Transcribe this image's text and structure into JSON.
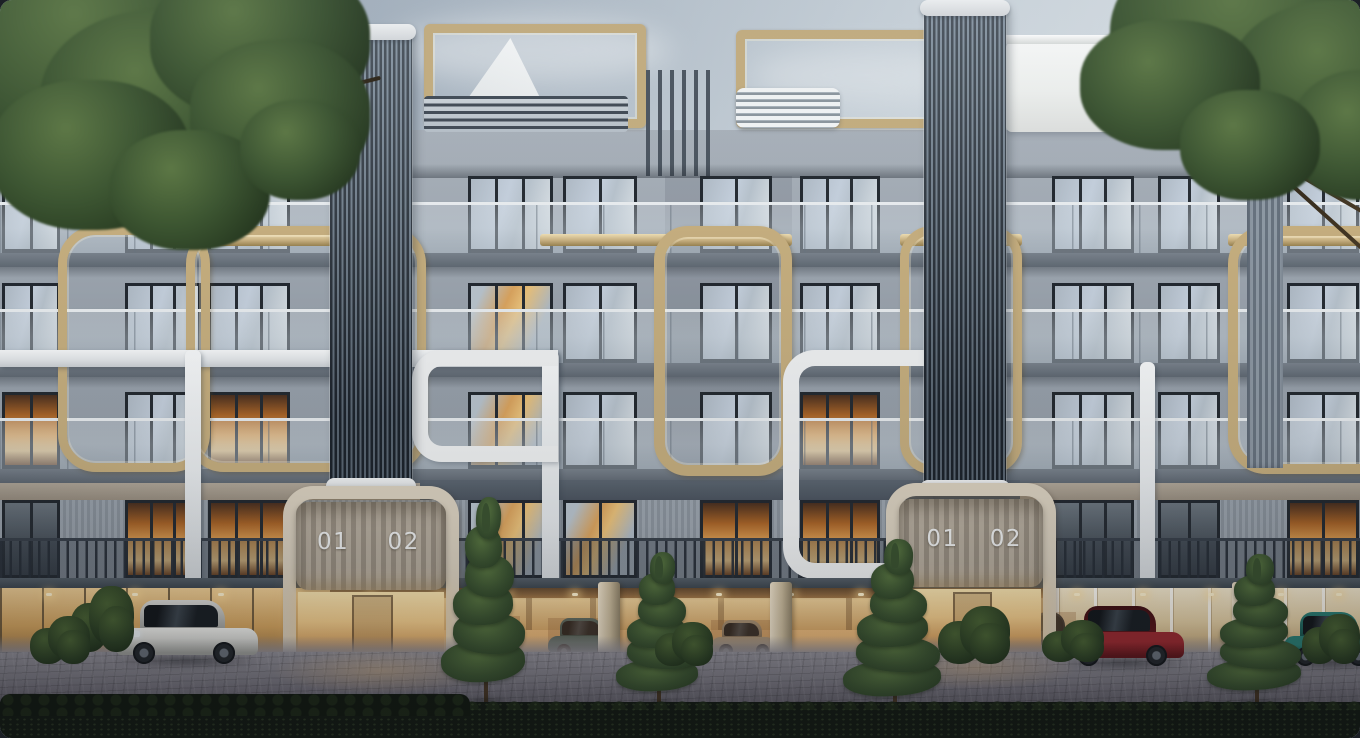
{
  "labels": {
    "entrance_left": {
      "unit1": "01",
      "unit2": "02"
    },
    "entrance_right": {
      "unit1": "01",
      "unit2": "02"
    }
  },
  "palette": {
    "sky_top": "#8f9dac",
    "sky_bottom": "#e9edf0",
    "cloud": "#eef1f3",
    "facade": "#99a2ac",
    "facade_light": "#a8b0b9",
    "slab": "#646d77",
    "soffit": "#3a424c",
    "tower_dark": "#222a33",
    "tower_light": "#738290",
    "tower_cap": "#f0f2f3",
    "gold": "#c4ad7e",
    "gold_light": "#ecdcb2",
    "gold_dark": "#97814f",
    "white_trim": "#edeff0",
    "arch_trim": "#d8cfbe",
    "window_frame": "#232930",
    "glass_sky": "#c3cedb",
    "glass_warm": "#e8ab5d",
    "panel_light": "#b4ab9d",
    "panel_dark": "#968d80",
    "number_color": "#f0f2f3",
    "railing": "#2b333c",
    "garage_glow": "#eab97b",
    "lobby_glow": "#f3cd8c",
    "pavement_top": "#8f8d95",
    "pavement_bottom": "#44414d",
    "hedge": "#131a12",
    "pine": "#3a5230",
    "foliage": "#3c5531",
    "car_silver": "#dcdcd8",
    "car_red": "#9b2a30",
    "car_teal": "#2c8076",
    "car_teal_sedan": "#4b6e70",
    "car_champagne": "#b3a68d",
    "car_dark": "#3c4146"
  },
  "scene": {
    "floors": [
      {
        "y": 176,
        "h": 77,
        "rail": "glass"
      },
      {
        "y": 283,
        "h": 80,
        "rail": "glass"
      },
      {
        "y": 392,
        "h": 77,
        "rail": "glass"
      },
      {
        "y": 500,
        "h": 79,
        "rail": "bars"
      }
    ],
    "window_cols": [
      {
        "x": 2,
        "w": 58
      },
      {
        "x": 125,
        "w": 76
      },
      {
        "x": 208,
        "w": 82
      },
      {
        "x": 468,
        "w": 85
      },
      {
        "x": 563,
        "w": 74
      },
      {
        "x": 700,
        "w": 72
      },
      {
        "x": 800,
        "w": 80
      },
      {
        "x": 1052,
        "w": 82
      },
      {
        "x": 1158,
        "w": 62
      },
      {
        "x": 1287,
        "w": 72
      }
    ],
    "lit": [
      [
        2,
        0
      ],
      [
        2,
        2
      ],
      [
        2,
        6
      ],
      [
        3,
        1
      ],
      [
        3,
        2
      ],
      [
        3,
        5
      ],
      [
        3,
        6
      ],
      [
        3,
        9
      ]
    ],
    "warm_reflect": [
      [
        1,
        3
      ],
      [
        2,
        3
      ],
      [
        3,
        3
      ],
      [
        3,
        4
      ]
    ],
    "towers": [
      {
        "x": 330,
        "y": 30,
        "w": 82,
        "h": 457
      },
      {
        "x": 924,
        "y": 6,
        "w": 82,
        "h": 483
      }
    ],
    "pergolas": [
      [
        140,
        34,
        193,
        78
      ],
      [
        424,
        24,
        204,
        86
      ],
      [
        736,
        30,
        192,
        80
      ]
    ],
    "slat_bands": [
      [
        86,
        96,
        244,
        36
      ],
      [
        424,
        96,
        204,
        36
      ]
    ],
    "white_crowns": [
      [
        736,
        88,
        104,
        40
      ],
      [
        1314,
        88,
        46,
        40
      ]
    ],
    "roof_caps": [
      [
        78,
        126,
        260,
        24
      ],
      [
        408,
        126,
        254,
        24
      ],
      [
        708,
        126,
        224,
        24
      ]
    ],
    "white_block": [
      1006,
      42,
      176,
      90
    ],
    "sail": [
      436,
      38,
      120,
      92
    ],
    "fins": [
      646,
      70,
      72,
      106
    ],
    "gold_bands": [
      [
        186,
        334
      ],
      [
        540,
        792
      ],
      [
        900,
        1022
      ],
      [
        1228,
        1360
      ]
    ],
    "gold_frames": [
      [
        58,
        226,
        152,
        246,
        38,
        9
      ],
      [
        186,
        226,
        240,
        246,
        38,
        9
      ],
      [
        654,
        226,
        138,
        250,
        34,
        11
      ],
      [
        900,
        226,
        122,
        248,
        32,
        9
      ],
      [
        1228,
        226,
        200,
        248,
        38,
        10
      ]
    ],
    "white_tubes": [
      {
        "t": "bar",
        "x": 0,
        "y": 350,
        "w": 558,
        "h": 17,
        "rr": "0 14px 14px 0"
      },
      {
        "t": "bar",
        "x": 185,
        "y": 350,
        "w": 16,
        "h": 300,
        "rr": "6px"
      },
      {
        "t": "bar",
        "x": 542,
        "y": 350,
        "w": 17,
        "h": 300,
        "rr": "8px"
      },
      {
        "t": "frame",
        "x": 412,
        "y": 350,
        "w": 146,
        "h": 112,
        "r": "30px 0 0 30px"
      },
      {
        "t": "frame",
        "x": 783,
        "y": 350,
        "w": 150,
        "h": 229,
        "r": "32px 0 0 32px"
      },
      {
        "t": "bar",
        "x": 1140,
        "y": 362,
        "w": 15,
        "h": 292,
        "rr": "6px"
      }
    ],
    "fin_column": [
      1247,
      176,
      36,
      292
    ],
    "pillars": [
      [
        598,
        22
      ],
      [
        770,
        22
      ],
      [
        1232,
        24
      ]
    ],
    "lights_x": [
      46,
      132,
      218,
      300,
      368,
      436,
      504,
      572,
      646,
      716,
      788,
      858,
      1074,
      1140,
      1208,
      1278,
      1336
    ],
    "garage_cars": [
      {
        "kind": "sedan",
        "x": 548,
        "y": 618,
        "w": 72,
        "h": 42,
        "body": "#4b6e70",
        "dark": "#2e4a4c"
      },
      {
        "kind": "sedan",
        "x": 711,
        "y": 620,
        "w": 66,
        "h": 40,
        "body": "#b3a68d",
        "dark": "#7d7260"
      },
      {
        "kind": "sedan",
        "x": 462,
        "y": 616,
        "w": 58,
        "h": 40,
        "body": "#3c4146",
        "dark": "#23272b"
      },
      {
        "kind": "sedan",
        "x": 1028,
        "y": 612,
        "w": 48,
        "h": 46,
        "body": "#2e3338",
        "dark": "#1c2024"
      }
    ],
    "street_cars": [
      {
        "kind": "audi",
        "x": 116,
        "y": 600,
        "w": 142,
        "h": 66,
        "body": "#dcdcd8",
        "dark": "#9a9b97",
        "light": "#f2f2ee"
      },
      {
        "kind": "redsuv",
        "x": 1064,
        "y": 606,
        "w": 120,
        "h": 62,
        "body": "#9b2a30",
        "dark": "#5f161b",
        "roof": "#401114"
      },
      {
        "kind": "teal",
        "x": 1284,
        "y": 612,
        "w": 96,
        "h": 56,
        "body": "#2c8076",
        "dark": "#174f48"
      }
    ],
    "pines": [
      [
        444,
        492,
        84,
        212
      ],
      [
        618,
        548,
        82,
        158
      ],
      [
        846,
        534,
        98,
        180
      ],
      [
        1210,
        550,
        94,
        156
      ]
    ],
    "bushes": [
      [
        70,
        586,
        64,
        66
      ],
      [
        938,
        606,
        72,
        58
      ],
      [
        655,
        622,
        58,
        44
      ],
      [
        1042,
        620,
        62,
        42
      ],
      [
        1302,
        614,
        58,
        50
      ],
      [
        30,
        616,
        60,
        48
      ]
    ],
    "clouds": [
      [
        390,
        18,
        280,
        64,
        0.5
      ],
      [
        750,
        48,
        230,
        54,
        0.4
      ],
      [
        1120,
        14,
        260,
        66,
        0.42
      ],
      [
        150,
        55,
        210,
        48,
        0.32
      ]
    ],
    "foliage_left": [
      [
        -40,
        -60,
        300,
        230
      ],
      [
        40,
        10,
        250,
        190
      ],
      [
        150,
        -40,
        220,
        160
      ],
      [
        -10,
        80,
        200,
        150
      ],
      [
        190,
        40,
        180,
        150
      ],
      [
        110,
        130,
        160,
        120
      ],
      [
        240,
        100,
        120,
        100
      ]
    ],
    "foliage_right": [
      [
        1110,
        -70,
        320,
        220
      ],
      [
        1230,
        0,
        230,
        160
      ],
      [
        1080,
        20,
        180,
        130
      ],
      [
        1290,
        70,
        150,
        130
      ],
      [
        1180,
        90,
        140,
        110
      ]
    ],
    "branches_left": [
      [
        40,
        185,
        210,
        -24
      ],
      [
        150,
        140,
        190,
        -38
      ],
      [
        235,
        112,
        150,
        -14
      ]
    ],
    "branches_right": [
      [
        1140,
        40,
        260,
        22
      ],
      [
        1190,
        110,
        230,
        30
      ],
      [
        1255,
        150,
        170,
        42
      ]
    ]
  }
}
